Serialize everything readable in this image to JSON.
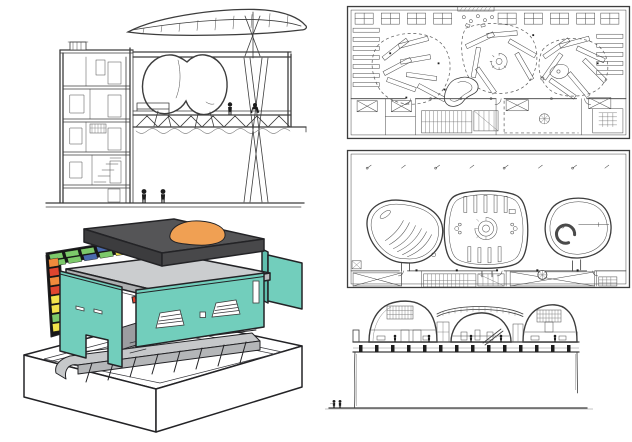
{
  "page": {
    "background": "#ffffff"
  },
  "colors": {
    "white": "#ffffff",
    "teal": "#72cebc",
    "teal_shade": "#5fbfae",
    "roof_top": "#555557",
    "roof_left": "#3c3c3e",
    "roof_right": "#48484a",
    "slab_top": "#cbcdcf",
    "slab_left": "#aeb0b2",
    "slab_right": "#bcbec0",
    "ramp": "#c6c8ca",
    "ramp_front": "#b4b6b8",
    "interior_gray": "#9b9da0",
    "orange_dome": "#f0a053",
    "red_accent": "#e0452f",
    "orange_accent": "#f08a3c",
    "black_panel": "#161616"
  },
  "model": {
    "facade": {
      "row_a": [
        "#7cc96a",
        "#7cc96a",
        "#7cc96a",
        "#4a6aae",
        "#7cc96a",
        "#f08a3c"
      ],
      "row_b": [
        "#7cc96a",
        "#7cc96a",
        "#4a6aae",
        "#7cc96a",
        "#e8d94b",
        "#e0452f"
      ],
      "strip": [
        "#f08a3c",
        "#e0452f",
        "#f08a3c",
        "#e0452f",
        "#f2e34b",
        "#f2e34b",
        "#7cc96a",
        "#f2e34b"
      ]
    }
  }
}
